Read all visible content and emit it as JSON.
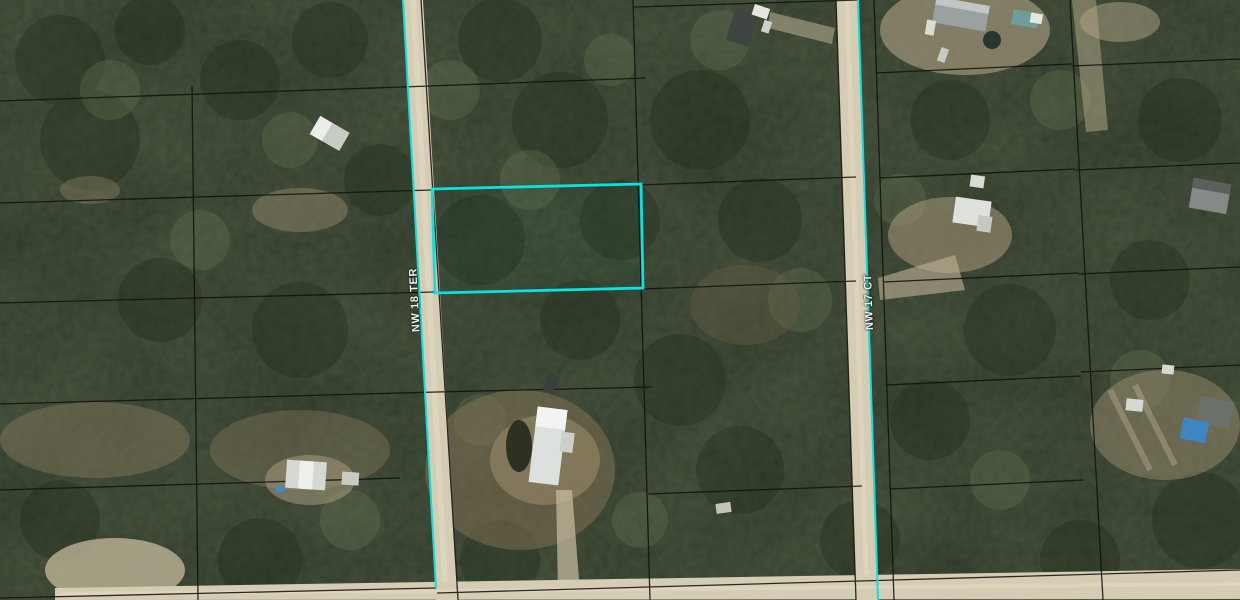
{
  "map": {
    "description": "Aerial photo parcel map of a wooded subdivision with a grid of lot boundary lines, two unpaved north-south roads, one unpaved road along the bottom edge, scattered homes in clearings, and one vacant lot highlighted with a cyan outline",
    "roads": [
      {
        "label": "NW 18 TER",
        "orientation": "vertical",
        "surface": "dirt"
      },
      {
        "label": "NW 17 CT",
        "orientation": "vertical",
        "surface": "dirt"
      },
      {
        "orientation": "horizontal-bottom",
        "surface": "dirt"
      }
    ],
    "highlighted_parcel": {
      "outline_color": "#0be0e3",
      "position": "upper-middle block, east side of NW 18 TER",
      "approx_bounds_px": {
        "x": 432,
        "y": 184,
        "width": 211,
        "height": 109
      }
    },
    "colors": {
      "parcel_line": "#141210",
      "road_surface": "#d5ccb4",
      "highlight_cyan": "#0be0e3",
      "forest_dark": "#2c3826",
      "forest_light": "#5e6c4c",
      "clearing_tan": "#a39272",
      "pool_blue": "#3e85c4"
    }
  }
}
